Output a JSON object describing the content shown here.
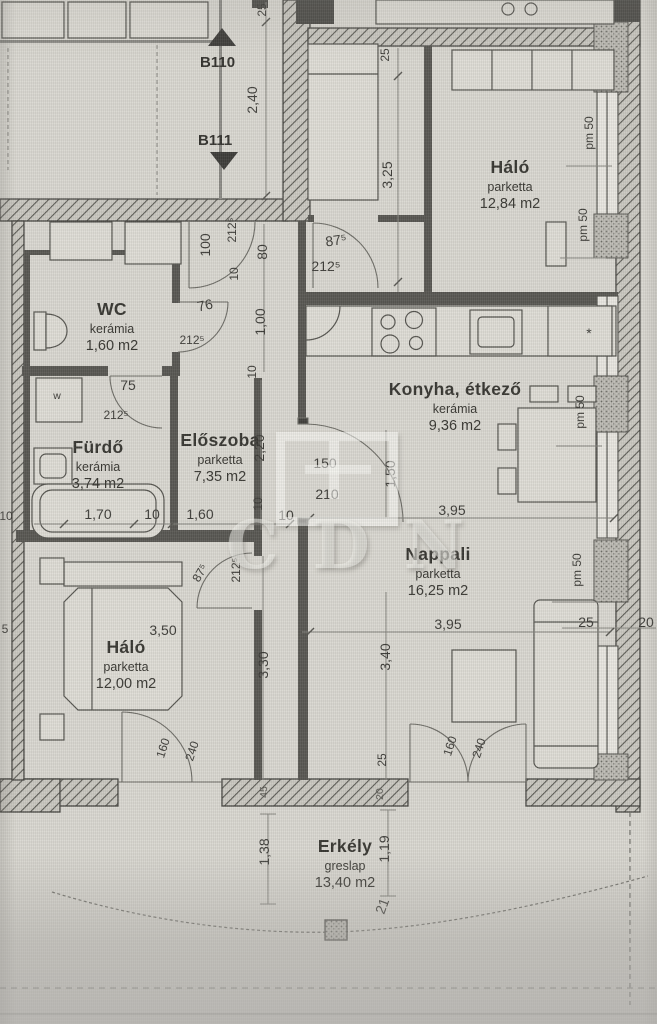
{
  "stairs": {
    "up_label": "B110",
    "down_label": "B111"
  },
  "rooms": [
    {
      "name": "Háló",
      "floor": "parketta",
      "area": "12,84 m2"
    },
    {
      "name": "WC",
      "floor": "kerámia",
      "area": "1,60 m2"
    },
    {
      "name": "Fürdő",
      "floor": "kerámia",
      "area": "3,74 m2"
    },
    {
      "name": "Előszoba",
      "floor": "parketta",
      "area": "7,35 m2"
    },
    {
      "name": "Konyha, étkező",
      "floor": "kerámia",
      "area": "9,36 m2"
    },
    {
      "name": "Nappali",
      "floor": "parketta",
      "area": "16,25 m2"
    },
    {
      "name": "Háló",
      "floor": "parketta",
      "area": "12,00 m2"
    },
    {
      "name": "Erkély",
      "floor": "greslap",
      "area": "13,40 m2"
    }
  ],
  "dims": [
    {
      "text": "25"
    },
    {
      "text": "2,40"
    },
    {
      "text": "25"
    },
    {
      "text": "3,25"
    },
    {
      "text": "pm 50"
    },
    {
      "text": "pm 50"
    },
    {
      "text": "100"
    },
    {
      "text": "212⁵"
    },
    {
      "text": "10"
    },
    {
      "text": "80"
    },
    {
      "text": "1,00"
    },
    {
      "text": "87⁵"
    },
    {
      "text": "212⁵"
    },
    {
      "text": "76"
    },
    {
      "text": "212⁵"
    },
    {
      "text": "75"
    },
    {
      "text": "212⁵"
    },
    {
      "text": "10"
    },
    {
      "text": "2,20"
    },
    {
      "text": "10"
    },
    {
      "text": "1,70"
    },
    {
      "text": "10"
    },
    {
      "text": "1,60"
    },
    {
      "text": "150"
    },
    {
      "text": "210"
    },
    {
      "text": "1,50"
    },
    {
      "text": "10"
    },
    {
      "text": "3,95"
    },
    {
      "text": "pm 50"
    },
    {
      "text": "*"
    },
    {
      "text": "pm 50"
    },
    {
      "text": "3,95"
    },
    {
      "text": "25"
    },
    {
      "text": "20"
    },
    {
      "text": "3,50"
    },
    {
      "text": "87⁵"
    },
    {
      "text": "212⁵"
    },
    {
      "text": "3,30"
    },
    {
      "text": "3,40"
    },
    {
      "text": "160"
    },
    {
      "text": "240"
    },
    {
      "text": "160"
    },
    {
      "text": "240"
    },
    {
      "text": "25"
    },
    {
      "text": "45"
    },
    {
      "text": "20"
    },
    {
      "text": "1,38"
    },
    {
      "text": "1,19"
    },
    {
      "text": "21"
    },
    {
      "text": "w"
    },
    {
      "text": "10"
    },
    {
      "text": "5"
    }
  ],
  "watermark": {
    "text": "CDN"
  }
}
